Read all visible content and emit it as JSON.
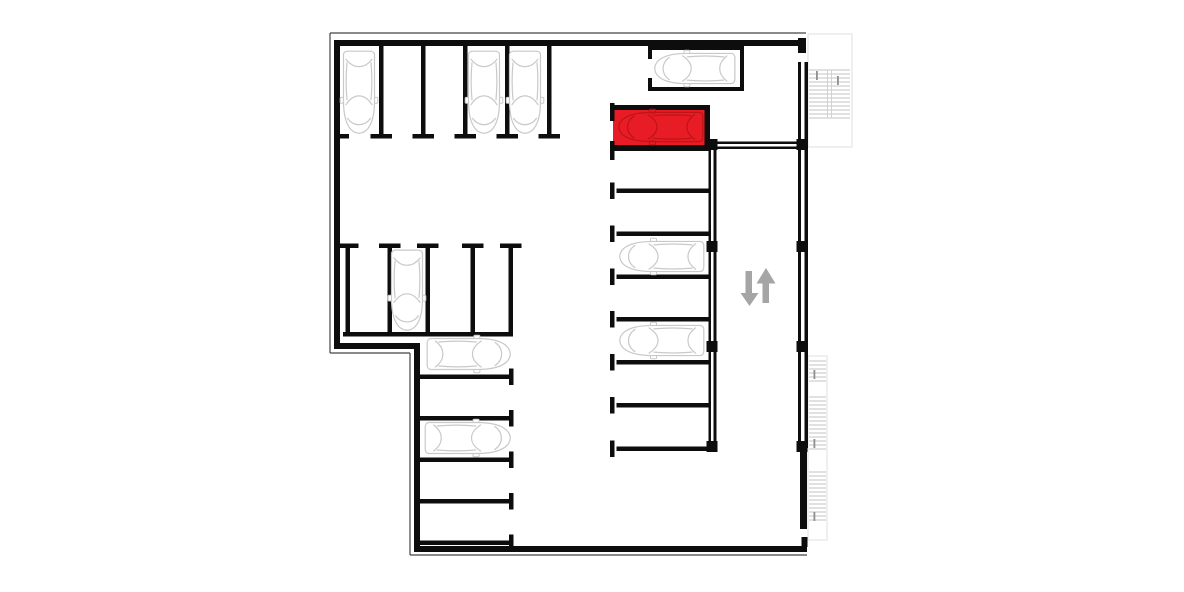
{
  "scene": {
    "type": "parking-floor-plan",
    "viewBox": "0 0 1184 592",
    "colors": {
      "background": "#ffffff",
      "wall": "#0d0d0d",
      "thin_line": "#454545",
      "car_stroke": "#c9c9c9",
      "car_fill": "#ffffff",
      "highlight_fill": "#e81c24",
      "highlight_car_stroke": "#bf1219",
      "arrow": "#a5a5a5",
      "stair_tread": "#c3c3c3",
      "stair_rail": "#d2d2d2",
      "stair_outline": "#e4e4e4",
      "stair_dash": "#8f8f8f"
    },
    "thin_lines": [
      [
        330,
        33,
        806,
        33
      ],
      [
        330,
        33,
        330,
        353
      ],
      [
        330,
        353,
        410,
        353
      ],
      [
        410,
        353,
        410,
        555
      ],
      [
        410,
        555,
        807,
        555
      ]
    ],
    "highlight_space": {
      "x": 613,
      "y": 109,
      "w": 92,
      "h": 37
    },
    "solids": [
      {
        "name": "exterior-wall",
        "rects": [
          [
            334,
            40,
            472,
            6
          ],
          [
            334,
            40,
            6,
            309
          ],
          [
            334,
            343,
            86,
            6
          ],
          [
            414,
            343,
            6,
            209
          ],
          [
            414,
            546,
            393,
            6
          ],
          [
            798,
            38,
            8,
            15
          ],
          [
            798,
            62,
            3,
            386
          ],
          [
            804.5,
            62,
            3.5,
            386
          ],
          [
            800,
            450,
            7,
            79
          ],
          [
            801.5,
            537,
            6,
            10
          ]
        ]
      },
      {
        "name": "ramp-wall",
        "rects": [
          [
            708.5,
            140,
            2.5,
            306
          ],
          [
            713.5,
            140,
            3,
            306
          ],
          [
            717,
            141.5,
            81,
            2.5
          ],
          [
            717,
            146.5,
            81,
            2.5
          ]
        ]
      },
      {
        "name": "structural-column",
        "rects": [
          [
            706.5,
            139,
            11,
            11
          ],
          [
            706.5,
            241,
            11,
            11
          ],
          [
            706.5,
            341,
            11,
            11
          ],
          [
            706.5,
            441,
            11,
            11
          ],
          [
            796.5,
            139,
            11,
            11
          ],
          [
            796.5,
            241,
            11,
            11
          ],
          [
            796.5,
            341,
            11,
            11
          ],
          [
            796.5,
            441,
            11,
            11
          ]
        ]
      },
      {
        "name": "parking-bay-wall",
        "rects": [
          [
            648,
            46,
            96,
            4
          ],
          [
            740,
            46,
            4,
            45
          ],
          [
            648,
            87,
            96,
            4
          ],
          [
            648,
            46,
            4,
            13
          ],
          [
            648,
            78,
            4,
            13
          ]
        ]
      },
      {
        "name": "highlighted-space-border",
        "rects": [
          [
            612,
            105,
            97,
            5
          ],
          [
            704.5,
            105,
            5.5,
            46
          ],
          [
            612,
            145,
            97,
            6
          ],
          [
            610,
            103,
            4.5,
            18
          ],
          [
            610,
            141,
            4.5,
            19
          ]
        ]
      },
      {
        "name": "parking-divider",
        "rects": [
          [
            379,
            46,
            4.5,
            90
          ],
          [
            421,
            46,
            4.5,
            90
          ],
          [
            463,
            46,
            4.5,
            90
          ],
          [
            505,
            46,
            4.5,
            90
          ],
          [
            547,
            46,
            4.5,
            90
          ],
          [
            345.5,
            246,
            4.5,
            90
          ],
          [
            387.5,
            246,
            4.5,
            90
          ],
          [
            425.5,
            246,
            4.5,
            90
          ],
          [
            470.5,
            246,
            4.5,
            90
          ],
          [
            508.5,
            246,
            4.5,
            90
          ],
          [
            343,
            332,
            170,
            4.5
          ],
          [
            418,
            374.5,
            92,
            4.5
          ],
          [
            418,
            416,
            92,
            4.5
          ],
          [
            418,
            457.5,
            92,
            4.5
          ],
          [
            418,
            499,
            92,
            4.5
          ],
          [
            418,
            540.5,
            92,
            4.5
          ],
          [
            616.5,
            188.5,
            92,
            4.5
          ],
          [
            616.5,
            231.5,
            92,
            4.5
          ],
          [
            616.5,
            274.5,
            92,
            4.5
          ],
          [
            616.5,
            317,
            92,
            4.5
          ],
          [
            616.5,
            360,
            92,
            4.5
          ],
          [
            616.5,
            403,
            92,
            4.5
          ],
          [
            616.5,
            446.5,
            92,
            4.5
          ]
        ]
      },
      {
        "name": "divider-cap",
        "rects": [
          [
            370.5,
            134,
            21.5,
            4.5
          ],
          [
            412.5,
            134,
            21.5,
            4.5
          ],
          [
            454.5,
            134,
            21.5,
            4.5
          ],
          [
            496.5,
            134,
            21.5,
            4.5
          ],
          [
            538.5,
            134,
            21.5,
            4.5
          ],
          [
            340,
            134,
            9,
            4.5
          ],
          [
            337,
            243.5,
            21.5,
            4.5
          ],
          [
            379,
            243.5,
            21.5,
            4.5
          ],
          [
            417,
            243.5,
            21.5,
            4.5
          ],
          [
            462,
            243.5,
            21.5,
            4.5
          ],
          [
            500,
            243.5,
            21.5,
            4.5
          ],
          [
            509,
            368.5,
            4.5,
            16.5
          ],
          [
            509,
            410,
            4.5,
            16.5
          ],
          [
            509,
            451.5,
            4.5,
            16.5
          ],
          [
            509,
            493,
            4.5,
            16.5
          ],
          [
            509,
            534.5,
            4.5,
            16.5
          ],
          [
            610,
            182.5,
            4.5,
            16.5
          ],
          [
            610,
            225.5,
            4.5,
            16.5
          ],
          [
            610,
            268.5,
            4.5,
            16.5
          ],
          [
            610,
            311,
            4.5,
            16.5
          ],
          [
            610,
            354,
            4.5,
            16.5
          ],
          [
            610,
            397,
            4.5,
            16.5
          ],
          [
            610,
            440.5,
            4.5,
            16.5
          ]
        ]
      }
    ],
    "cars": [
      {
        "x": 342,
        "y": 50,
        "w": 34,
        "h": 84,
        "dir": "down",
        "variant": "default"
      },
      {
        "x": 467,
        "y": 50,
        "w": 34,
        "h": 84,
        "dir": "down",
        "variant": "default"
      },
      {
        "x": 508,
        "y": 50,
        "w": 34,
        "h": 84,
        "dir": "down",
        "variant": "default"
      },
      {
        "x": 654,
        "y": 52,
        "w": 82,
        "h": 33,
        "dir": "left",
        "variant": "default"
      },
      {
        "x": 618,
        "y": 111,
        "w": 86,
        "h": 32,
        "dir": "left",
        "variant": "highlight"
      },
      {
        "x": 390,
        "y": 249,
        "w": 34,
        "h": 82,
        "dir": "down",
        "variant": "default"
      },
      {
        "x": 619,
        "y": 240,
        "w": 86,
        "h": 33,
        "dir": "left",
        "variant": "default"
      },
      {
        "x": 619,
        "y": 324,
        "w": 86,
        "h": 33,
        "dir": "left",
        "variant": "default"
      },
      {
        "x": 426,
        "y": 337,
        "w": 85,
        "h": 34,
        "dir": "right",
        "variant": "default"
      },
      {
        "x": 424,
        "y": 421,
        "w": 87,
        "h": 34,
        "dir": "right",
        "variant": "default"
      }
    ],
    "stairs": [
      {
        "name": "stairs-top-right",
        "outline": [
          808,
          34,
          44,
          113
        ],
        "tread_groups": [
          {
            "x": 809,
            "y": 70,
            "len": 41,
            "count": 13,
            "step": 4
          }
        ],
        "rails": [
          [
            827.5,
            70,
            118
          ],
          [
            831.5,
            70,
            118
          ]
        ],
        "dashes": [
          [
            816,
            71
          ],
          [
            837,
            76
          ]
        ]
      },
      {
        "name": "stairs-right",
        "outline": [
          808,
          356,
          19,
          184
        ],
        "tread_groups": [
          {
            "x": 809,
            "y": 361,
            "len": 17,
            "count": 6,
            "step": 4
          },
          {
            "x": 809,
            "y": 397,
            "len": 17,
            "count": 14,
            "step": 4
          },
          {
            "x": 809,
            "y": 472,
            "len": 17,
            "count": 13,
            "step": 4
          }
        ],
        "rails": [],
        "dashes": [
          [
            813.5,
            370
          ],
          [
            813.5,
            439
          ],
          [
            813.5,
            512
          ]
        ]
      }
    ],
    "ramp_arrows": [
      {
        "dir": "down",
        "shaft": [
          745.5,
          271,
          6.5,
          23
        ],
        "head": "740.5,293 758.5,293 749.5,306"
      },
      {
        "dir": "up",
        "shaft": [
          762.5,
          282,
          6.5,
          21
        ],
        "head": "756.5,283.5 775.5,283.5 766,268"
      }
    ]
  }
}
